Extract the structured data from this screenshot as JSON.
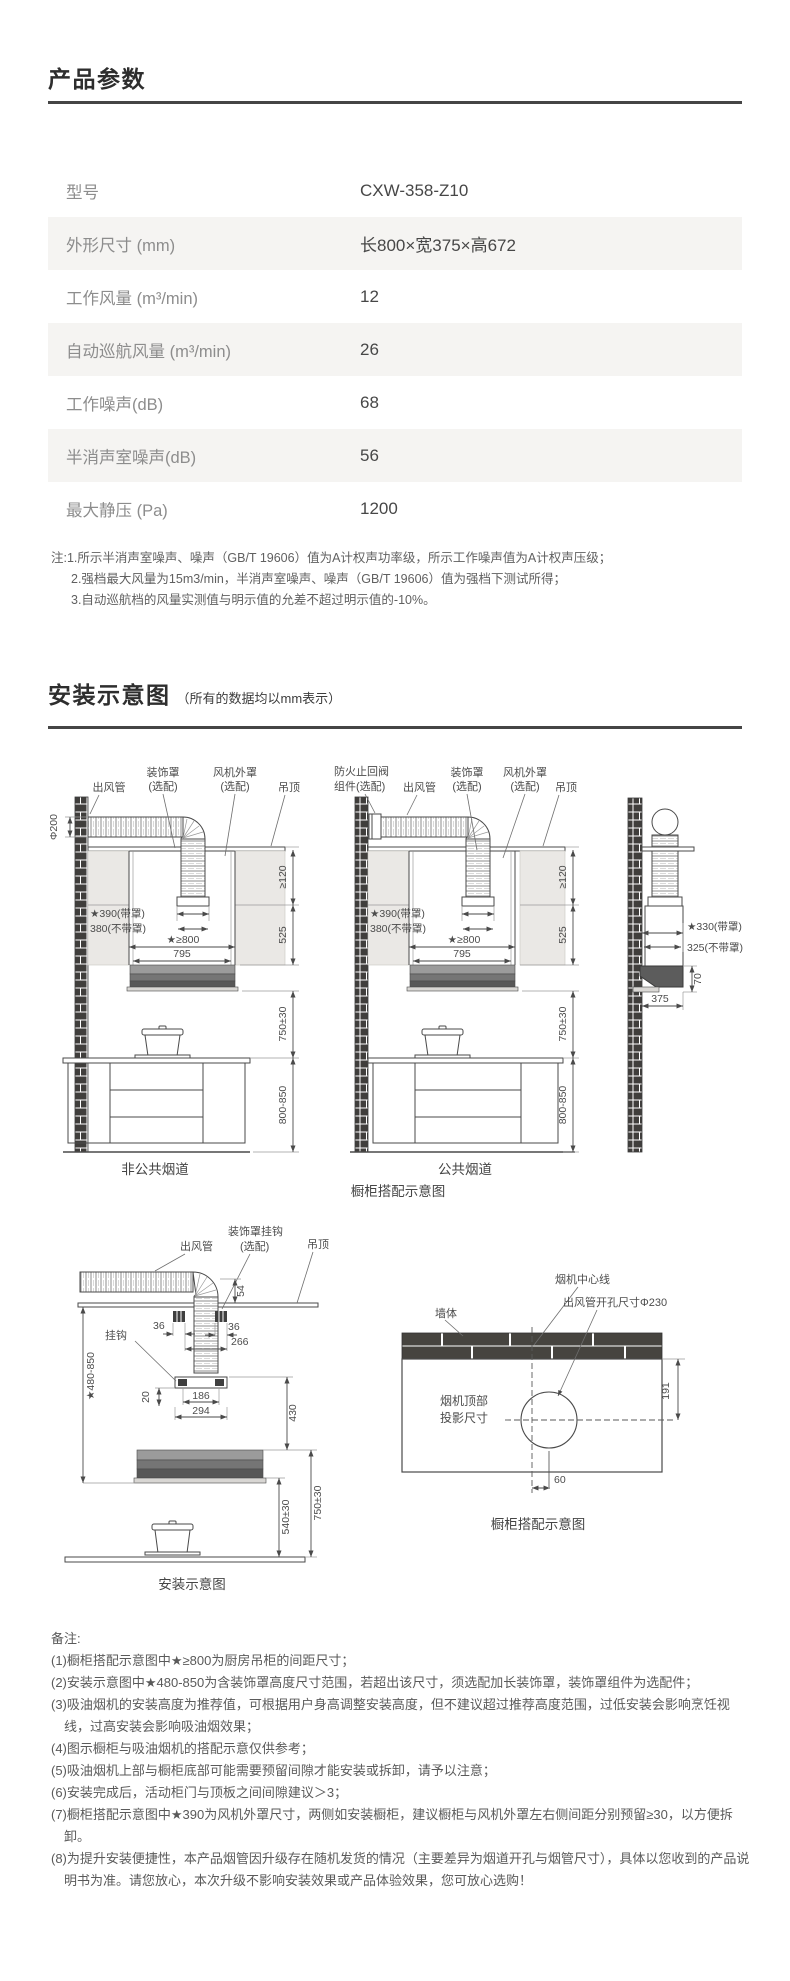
{
  "page": {
    "bg": "#ffffff",
    "accent_dark": "#454545",
    "row_alt_bg": "#f5f4f2"
  },
  "product_params": {
    "title": "产品参数",
    "rows": [
      {
        "label": "型号",
        "value": "CXW-358-Z10"
      },
      {
        "label": "外形尺寸 (mm)",
        "value": "长800×宽375×高672"
      },
      {
        "label": "工作风量 (m³/min)",
        "value": "12"
      },
      {
        "label": "自动巡航风量 (m³/min)",
        "value": "26"
      },
      {
        "label": "工作噪声(dB)",
        "value": "68"
      },
      {
        "label": "半消声室噪声(dB)",
        "value": "56"
      },
      {
        "label": "最大静压 (Pa)",
        "value": "1200"
      }
    ],
    "notes": [
      "注:1.所示半消声室噪声、噪声（GB/T 19606）值为A计权声功率级，所示工作噪声值为A计权声压级；",
      "2.强档最大风量为15m3/min，半消声室噪声、噪声（GB/T 19606）值为强档下测试所得；",
      "3.自动巡航档的风量实测值与明示值的允差不超过明示值的-10%。"
    ]
  },
  "install": {
    "title": "安装示意图",
    "subtitle": "（所有的数据均以mm表示）",
    "shared": {
      "duct": "出风管",
      "cover": "装饰罩",
      "optional": "(选配)",
      "fan_cover": "风机外罩",
      "ceiling": "吊顶",
      "phi200": "Φ200",
      "w_cover": "★390(带罩)",
      "w_nocover": "380(不带罩)",
      "gap": "★≥800",
      "w795": "795",
      "h120": "≥120",
      "h525": "525",
      "h750": "750±30",
      "h800": "800-850"
    },
    "d1": {
      "caption": "非公共烟道"
    },
    "d2": {
      "caption": "公共烟道",
      "valve1": "防火止回阀",
      "valve2": "组件(选配)"
    },
    "d3": {
      "w_cover": "★330(带罩)",
      "w_nocover": "325(不带罩)",
      "d375": "375",
      "d70": "70"
    },
    "top_caption": "橱柜搭配示意图",
    "d4": {
      "caption": "安装示意图",
      "hook_cover1": "装饰罩挂钩",
      "hook": "挂钩",
      "d54": "54",
      "d36": "36",
      "d266": "266",
      "h480": "★480-850",
      "d20": "20",
      "d186": "186",
      "d294": "294",
      "h430": "430",
      "h540": "540±30"
    },
    "d5": {
      "caption": "橱柜搭配示意图",
      "center_line": "烟机中心线",
      "hole": "出风管开孔尺寸Φ230",
      "wall": "墙体",
      "proj1": "烟机顶部",
      "proj2": "投影尺寸",
      "d191": "191",
      "d60": "60"
    }
  },
  "remarks": {
    "title": "备注:",
    "items": [
      "(1)橱柜搭配示意图中★≥800为厨房吊柜的间距尺寸；",
      "(2)安装示意图中★480-850为含装饰罩高度尺寸范围，若超出该尺寸，须选配加长装饰罩，装饰罩组件为选配件；",
      "(3)吸油烟机的安装高度为推荐值，可根据用户身高调整安装高度，但不建议超过推荐高度范围，过低安装会影响烹饪视线，过高安装会影响吸油烟效果；",
      "(4)图示橱柜与吸油烟机的搭配示意仅供参考；",
      "(5)吸油烟机上部与橱柜底部可能需要预留间隙才能安装或拆卸，请予以注意；",
      "(6)安装完成后，活动柜门与顶板之间间隙建议＞3；",
      "(7)橱柜搭配示意图中★390为风机外罩尺寸，两侧如安装橱柜，建议橱柜与风机外罩左右侧间距分别预留≥30，以方便拆卸。",
      "(8)为提升安装便捷性，本产品烟管因升级存在随机发货的情况（主要差异为烟道开孔与烟管尺寸），具体以您收到的产品说明书为准。请您放心，本次升级不影响安装效果或产品体验效果，您可放心选购！"
    ]
  }
}
